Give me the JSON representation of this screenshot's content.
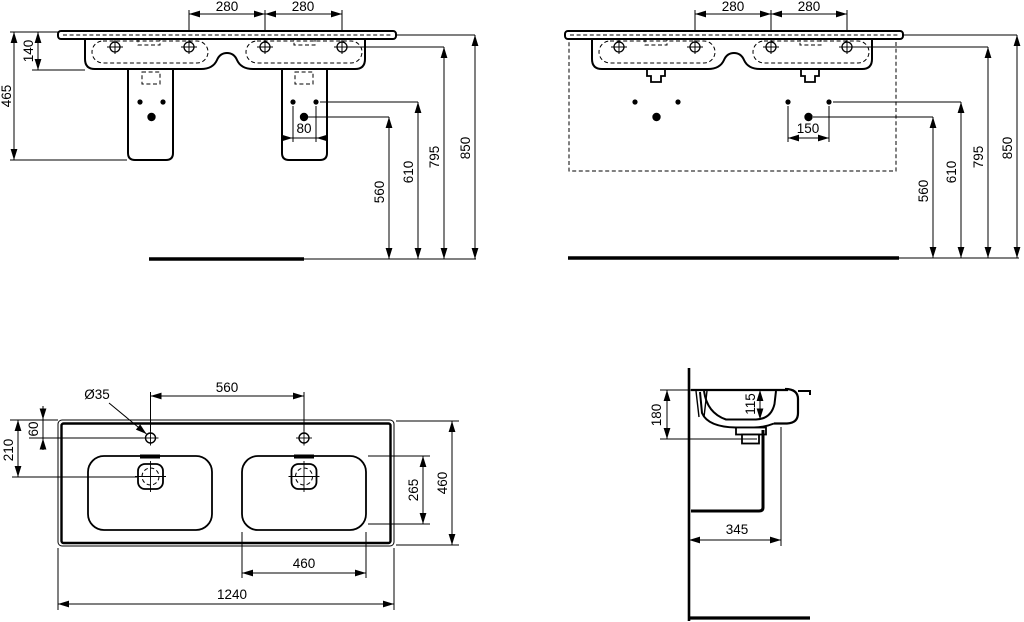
{
  "colors": {
    "background": "#ffffff",
    "line": "#000000"
  },
  "views": {
    "front_with_pedestals": {
      "dims": [
        "280",
        "280",
        "140",
        "465",
        "80",
        "560",
        "610",
        "795",
        "850"
      ]
    },
    "front_wall_hung": {
      "dims": [
        "280",
        "280",
        "150",
        "560",
        "610",
        "795",
        "850"
      ]
    },
    "plan": {
      "dims": [
        "Ø35",
        "560",
        "60",
        "210",
        "265",
        "460",
        "460",
        "1240"
      ]
    },
    "side_section": {
      "dims": [
        "180",
        "115",
        "345"
      ]
    }
  }
}
